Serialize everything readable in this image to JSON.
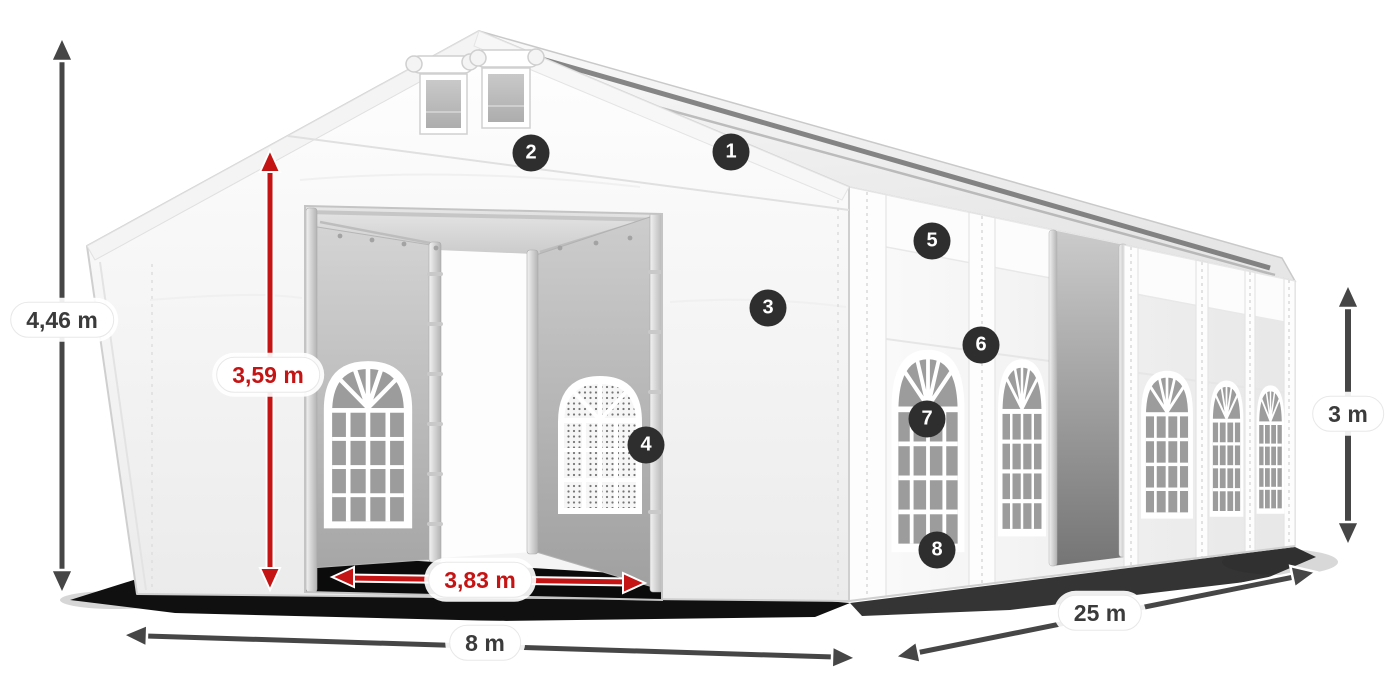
{
  "diagram": {
    "dimensions": {
      "total_height": "4,46 m",
      "inner_height": "3,59 m",
      "entrance_width": "3,83 m",
      "width": "8 m",
      "length": "25 m",
      "side_height": "3 m"
    },
    "badges": [
      "1",
      "2",
      "3",
      "4",
      "5",
      "6",
      "7",
      "8"
    ],
    "colors": {
      "dimension_primary": "#3f3f3f",
      "dimension_accent_red": "#c51414",
      "badge_background": "#2e2e2e",
      "badge_text": "#ffffff",
      "tent_white": "#ffffff"
    }
  }
}
